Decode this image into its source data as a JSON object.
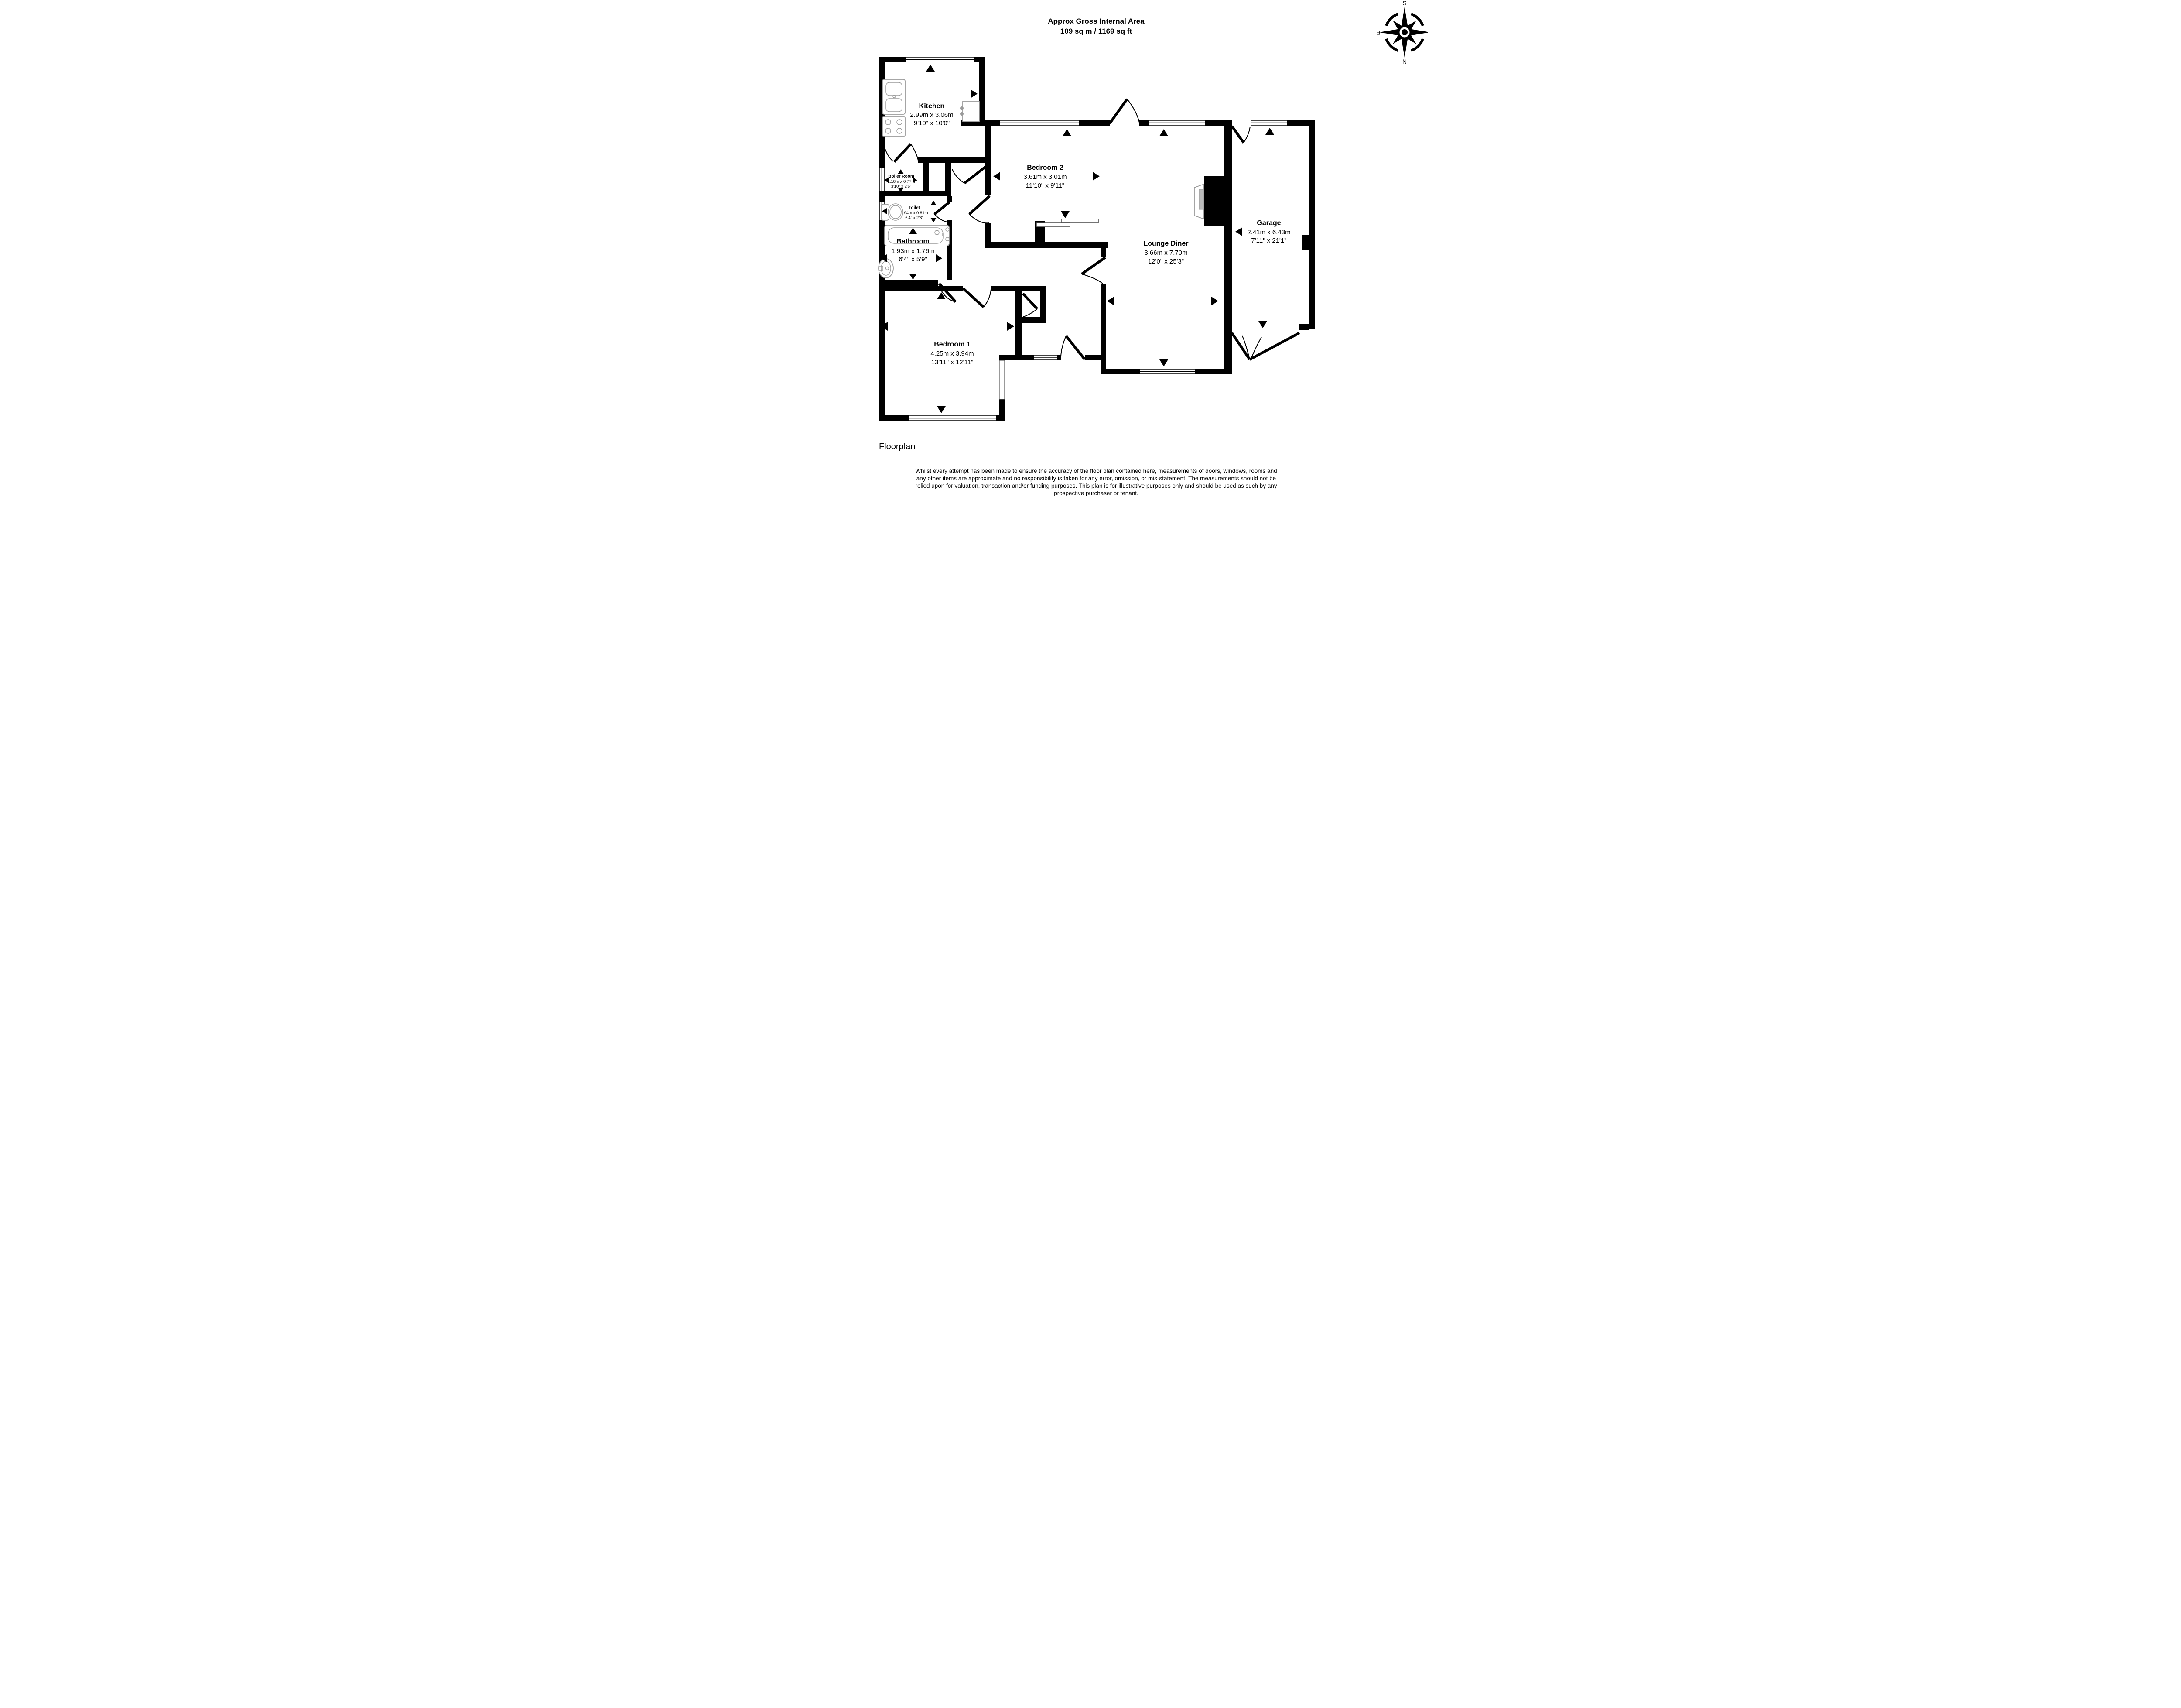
{
  "title": {
    "line1": "Approx Gross Internal Area",
    "line2": "109 sq m / 1169 sq ft"
  },
  "compass": {
    "north": "N",
    "south": "S",
    "east": "E",
    "west": "W"
  },
  "rooms": {
    "kitchen": {
      "name": "Kitchen",
      "metric": "2.99m x 3.06m",
      "imperial": "9'10\" x 10'0\""
    },
    "boiler_room": {
      "name": "Boiler Room",
      "metric": "1.18m x 0.77m",
      "imperial": "3'10\" x 2'6\""
    },
    "toilet": {
      "name": "Toilet",
      "metric": "1.94m x 0.81m",
      "imperial": "6'4\" x 2'8\""
    },
    "bathroom": {
      "name": "Bathroom",
      "metric": "1.93m x 1.76m",
      "imperial": "6'4\" x 5'9\""
    },
    "bedroom1": {
      "name": "Bedroom 1",
      "metric": "4.25m x 3.94m",
      "imperial": "13'11\" x 12'11\""
    },
    "bedroom2": {
      "name": "Bedroom 2",
      "metric": "3.61m x 3.01m",
      "imperial": "11'10\" x 9'11\""
    },
    "lounge_diner": {
      "name": "Lounge Diner",
      "metric": "3.66m x 7.70m",
      "imperial": "12'0\" x 25'3\""
    },
    "garage": {
      "name": "Garage",
      "metric": "2.41m x 6.43m",
      "imperial": "7'11\" x 21'1\""
    }
  },
  "footer": {
    "label": "Floorplan",
    "disclaimer_lines": [
      "Whilst every attempt has been made to ensure the accuracy of the floor plan contained here, measurements of doors, windows, rooms and",
      "any other items are approximate and no responsibility is taken for any error, omission, or mis-statement. The measurements should not be",
      "relied upon for valuation, transaction and/or funding purposes. This plan is for illustrative purposes only and should be used as such by any",
      "prospective purchaser or tenant."
    ]
  },
  "icons": {
    "measurement-arrow": "▲ (solid black triangle, points up/down/left/right marking room extents)",
    "compass-rose": "8-point star with ring, rotated 180° (S at top, N at bottom)",
    "fixtures": [
      "sink-unit",
      "hob",
      "toilet-pan",
      "bathtub",
      "wash-basin",
      "fireplace",
      "sliding-wardrobe-doors"
    ]
  },
  "colors": {
    "walls": "#000000",
    "fixtures": "#9a9a9a",
    "background": "#ffffff"
  }
}
